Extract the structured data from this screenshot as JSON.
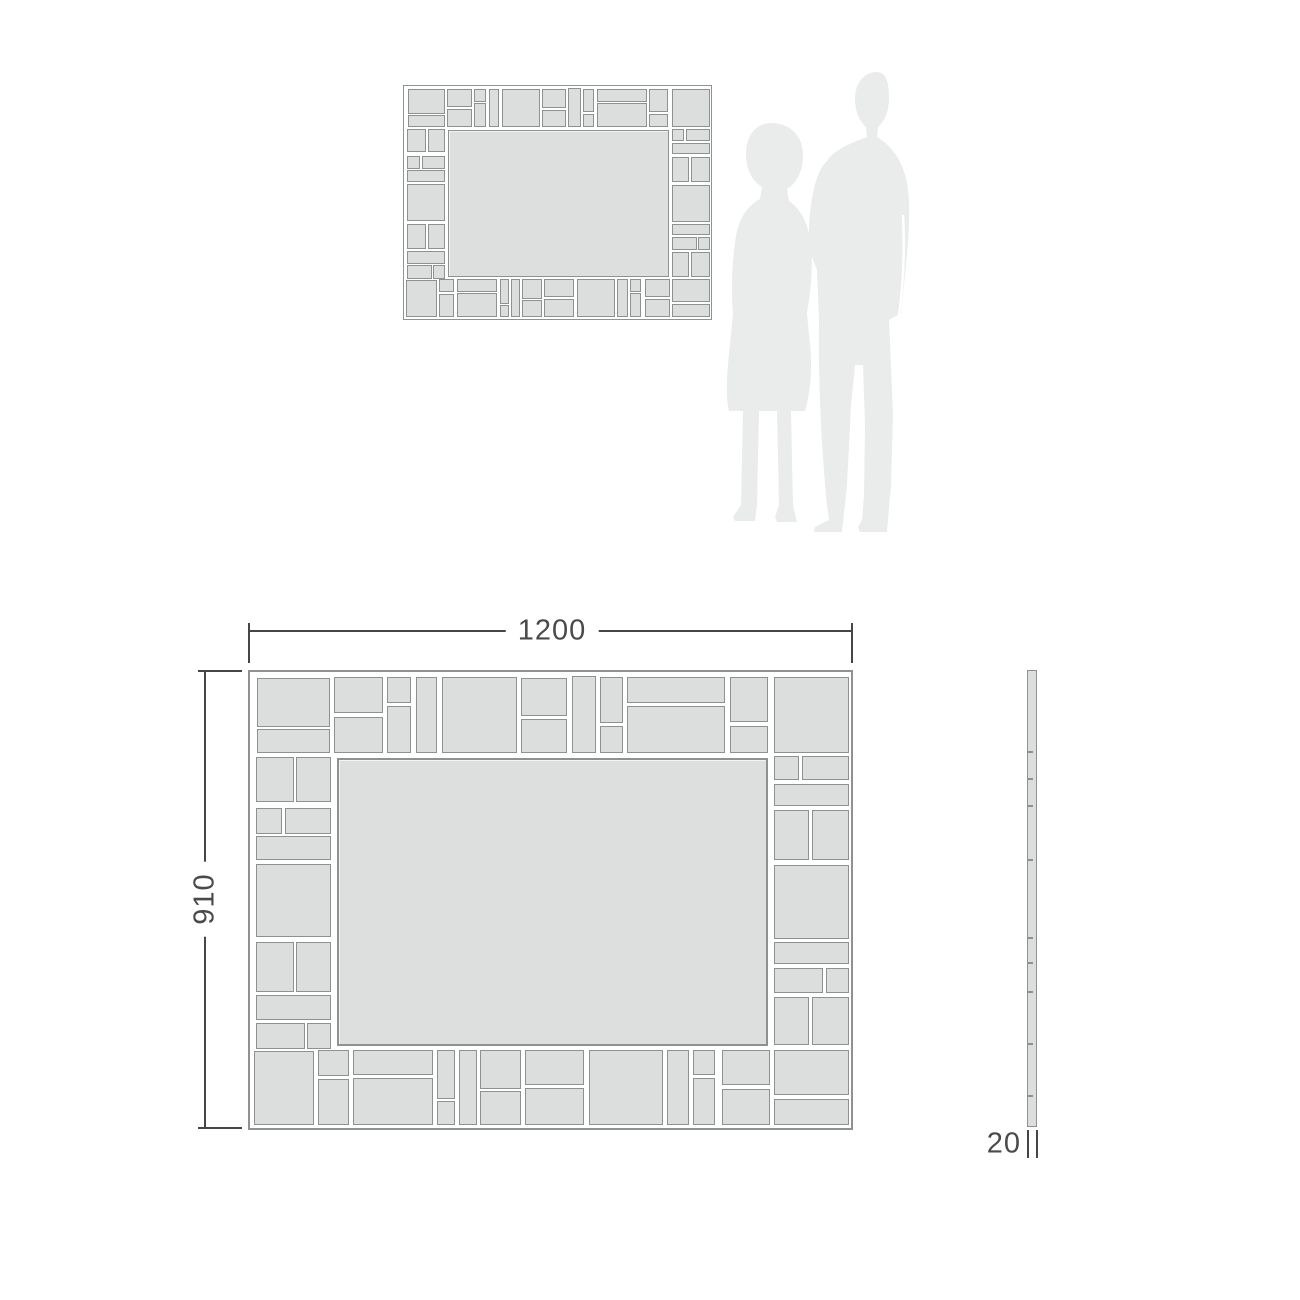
{
  "dimension_labels": {
    "width": "1200",
    "height": "910",
    "depth": "20"
  },
  "colors": {
    "background": "#ffffff",
    "tile_fill": "#dcdedd",
    "tile_border": "#8d918f",
    "frame_border": "#8f938f",
    "silhouette": "#eaebeb",
    "dimension_line": "#464646",
    "dimension_text": "#4a4a4a"
  },
  "mirror_design": {
    "width": 605,
    "height": 460,
    "panel": [
      87,
      86,
      431,
      288
    ],
    "tiles": [
      [
        7,
        6,
        73,
        49
      ],
      [
        7,
        57,
        73,
        24
      ],
      [
        84,
        5,
        49,
        36
      ],
      [
        84,
        45,
        49,
        36
      ],
      [
        137,
        5,
        24,
        26
      ],
      [
        137,
        34,
        24,
        47
      ],
      [
        166,
        5,
        21,
        76
      ],
      [
        192,
        5,
        75,
        76
      ],
      [
        271,
        6,
        46,
        38
      ],
      [
        271,
        47,
        46,
        34
      ],
      [
        322,
        4,
        24,
        77
      ],
      [
        350,
        5,
        23,
        46
      ],
      [
        350,
        54,
        23,
        27
      ],
      [
        377,
        5,
        98,
        26
      ],
      [
        377,
        34,
        98,
        47
      ],
      [
        480,
        5,
        38,
        45
      ],
      [
        480,
        54,
        38,
        27
      ],
      [
        524,
        5,
        75,
        76
      ],
      [
        6,
        85,
        38,
        45
      ],
      [
        46,
        85,
        35,
        45
      ],
      [
        6,
        136,
        26,
        26
      ],
      [
        35,
        136,
        46,
        26
      ],
      [
        6,
        164,
        75,
        24
      ],
      [
        6,
        192,
        75,
        73
      ],
      [
        6,
        270,
        38,
        50
      ],
      [
        46,
        270,
        35,
        50
      ],
      [
        6,
        323,
        75,
        25
      ],
      [
        6,
        351,
        49,
        26
      ],
      [
        57,
        351,
        24,
        26
      ],
      [
        524,
        84,
        25,
        24
      ],
      [
        552,
        84,
        47,
        24
      ],
      [
        524,
        112,
        75,
        22
      ],
      [
        524,
        138,
        35,
        50
      ],
      [
        562,
        138,
        37,
        50
      ],
      [
        524,
        193,
        75,
        74
      ],
      [
        524,
        270,
        75,
        22
      ],
      [
        524,
        296,
        49,
        25
      ],
      [
        576,
        296,
        23,
        25
      ],
      [
        524,
        325,
        35,
        48
      ],
      [
        562,
        325,
        37,
        48
      ],
      [
        4,
        379,
        60,
        74
      ],
      [
        68,
        378,
        31,
        26
      ],
      [
        68,
        407,
        31,
        46
      ],
      [
        103,
        378,
        80,
        25
      ],
      [
        103,
        406,
        80,
        47
      ],
      [
        187,
        378,
        18,
        49
      ],
      [
        187,
        429,
        18,
        24
      ],
      [
        209,
        378,
        18,
        75
      ],
      [
        230,
        378,
        41,
        39
      ],
      [
        230,
        419,
        41,
        34
      ],
      [
        275,
        378,
        59,
        35
      ],
      [
        275,
        416,
        59,
        37
      ],
      [
        339,
        378,
        74,
        75
      ],
      [
        417,
        378,
        22,
        75
      ],
      [
        443,
        378,
        22,
        25
      ],
      [
        443,
        406,
        22,
        47
      ],
      [
        472,
        378,
        48,
        35
      ],
      [
        472,
        417,
        48,
        36
      ],
      [
        524,
        378,
        75,
        45
      ],
      [
        524,
        427,
        75,
        26
      ]
    ]
  },
  "views": {
    "small": {
      "x": 403,
      "y": 85,
      "scale": 0.5107
    },
    "large": {
      "x": 248,
      "y": 670,
      "scale": 1
    },
    "side": {
      "x": 1027,
      "y": 670,
      "width": 10,
      "height": 457,
      "notches": [
        80,
        107,
        134,
        188,
        266,
        291,
        320,
        372,
        424
      ]
    }
  }
}
